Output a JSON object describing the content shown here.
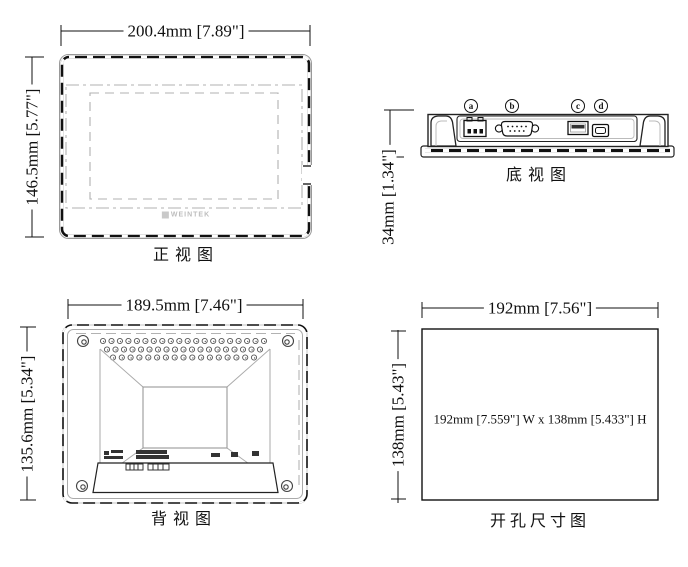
{
  "drawing": {
    "background_color": "#ffffff",
    "line_color": "#111111",
    "gray_line_color": "#aaaaaa",
    "views": {
      "front": {
        "title": "正视图",
        "width_dim": "200.4mm [7.89\"]",
        "height_dim": "146.5mm [5.77\"]",
        "logo_text": "WEINTEK"
      },
      "bottom": {
        "title": "底视图",
        "height_dim": "34mm [1.34\"]",
        "port_labels": [
          "a",
          "b",
          "c",
          "d"
        ]
      },
      "back": {
        "title": "背视图",
        "width_dim": "189.5mm [7.46\"]",
        "height_dim": "135.6mm [5.34\"]"
      },
      "cutout": {
        "title": "开孔尺寸图",
        "width_dim": "192mm [7.56\"]",
        "height_dim": "138mm [5.43\"]",
        "note": "192mm [7.559\"] W x 138mm [5.433\"] H"
      }
    }
  }
}
